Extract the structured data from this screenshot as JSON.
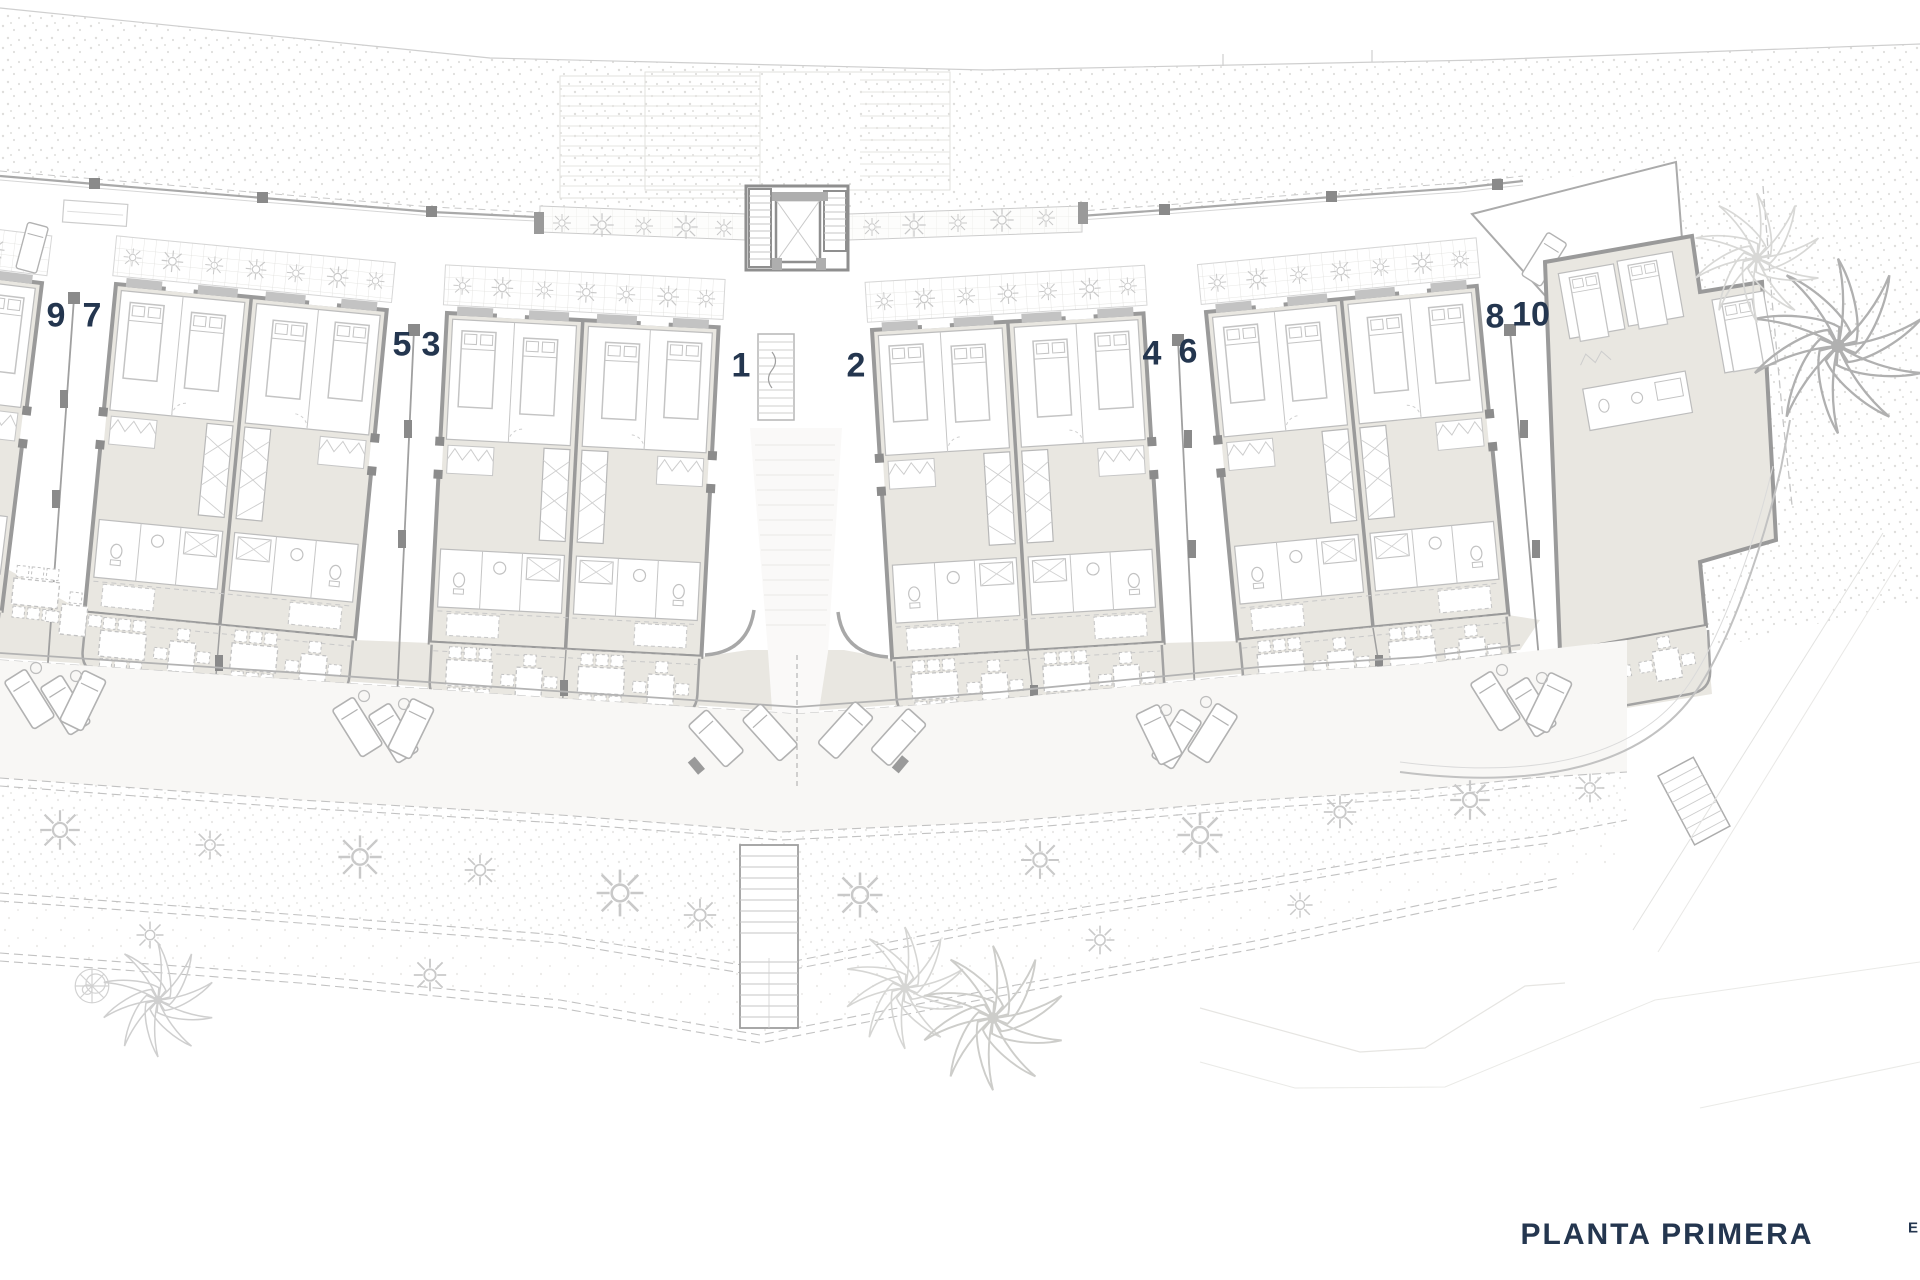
{
  "title": {
    "text": "PLANTA PRIMERA",
    "x": 1667,
    "y": 1235
  },
  "edge_label": {
    "text": "E",
    "x": 1913,
    "y": 1228
  },
  "colors": {
    "accent_navy": "#24364f",
    "building_fill": "#e9e7e1",
    "wall_gray": "#9a9a9a",
    "line_light": "#c6c6c6",
    "stipple_dot": "#d4d3d0",
    "background": "#ffffff"
  },
  "units": [
    {
      "label": "9",
      "x": 56,
      "y": 316
    },
    {
      "label": "7",
      "x": 92,
      "y": 316
    },
    {
      "label": "5",
      "x": 402,
      "y": 345
    },
    {
      "label": "3",
      "x": 431,
      "y": 345
    },
    {
      "label": "1",
      "x": 741,
      "y": 366
    },
    {
      "label": "2",
      "x": 856,
      "y": 366
    },
    {
      "label": "4",
      "x": 1152,
      "y": 354
    },
    {
      "label": "6",
      "x": 1188,
      "y": 352
    },
    {
      "label": "8",
      "x": 1495,
      "y": 317
    },
    {
      "label": "10",
      "x": 1531,
      "y": 315
    }
  ]
}
